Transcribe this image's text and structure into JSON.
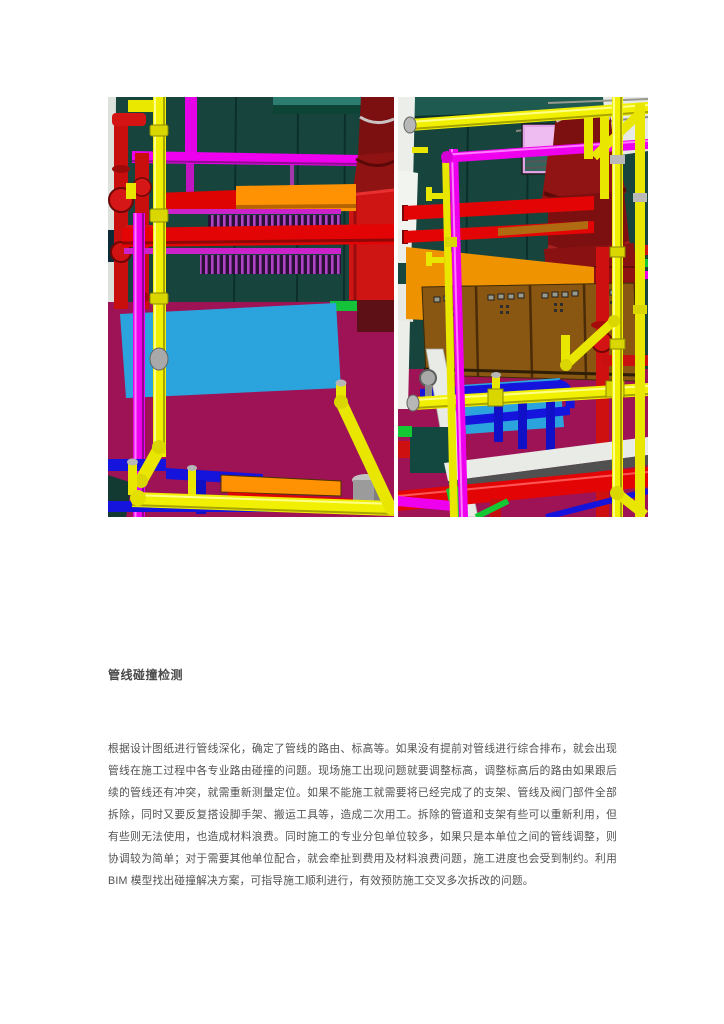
{
  "section": {
    "heading": "管线碰撞检测",
    "paragraph": "根据设计图纸进行管线深化，确定了管线的路由、标高等。如果没有提前对管线进行综合排布，就会出现管线在施工过程中各专业路由碰撞的问题。现场施工出现问题就要调整标高，调整标高后的路由如果跟后续的管线还有冲突，就需重新测量定位。如果不能施工就需要将已经完成了的支架、管线及阀门部件全部拆除，同时又要反复搭设脚手架、搬运工具等，造成二次用工。拆除的管道和支架有些可以重新利用，但有些则无法使用，也造成材料浪费。同时施工的专业分包单位较多，如果只是本单位之间的管线调整，则协调较为简单；对于需要其他单位配合，就会牵扯到费用及材料浪费问题，施工进度也会受到制约。利用 BIM 模型找出碰撞解决方案，可指导施工顺利进行，有效预防施工交叉多次拆改的问题。"
  },
  "palette": {
    "wall_teal": "#17453d",
    "pipe_yellow": "#f1ef02",
    "pipe_magenta": "#ee00ee",
    "pipe_red": "#e30505",
    "pipe_blue": "#1414dd",
    "pipe_orange": "#ff9202",
    "duct_dark_red": "#8e1111",
    "floor_crimson": "#9d1356",
    "floor_cyan": "#2ba4de",
    "cabinet_brown": "#8a5713",
    "window_pink": "#e2a3e6",
    "beam_white": "#e9ebe6",
    "green_accent": "#13c833",
    "text_color": "#515151"
  }
}
